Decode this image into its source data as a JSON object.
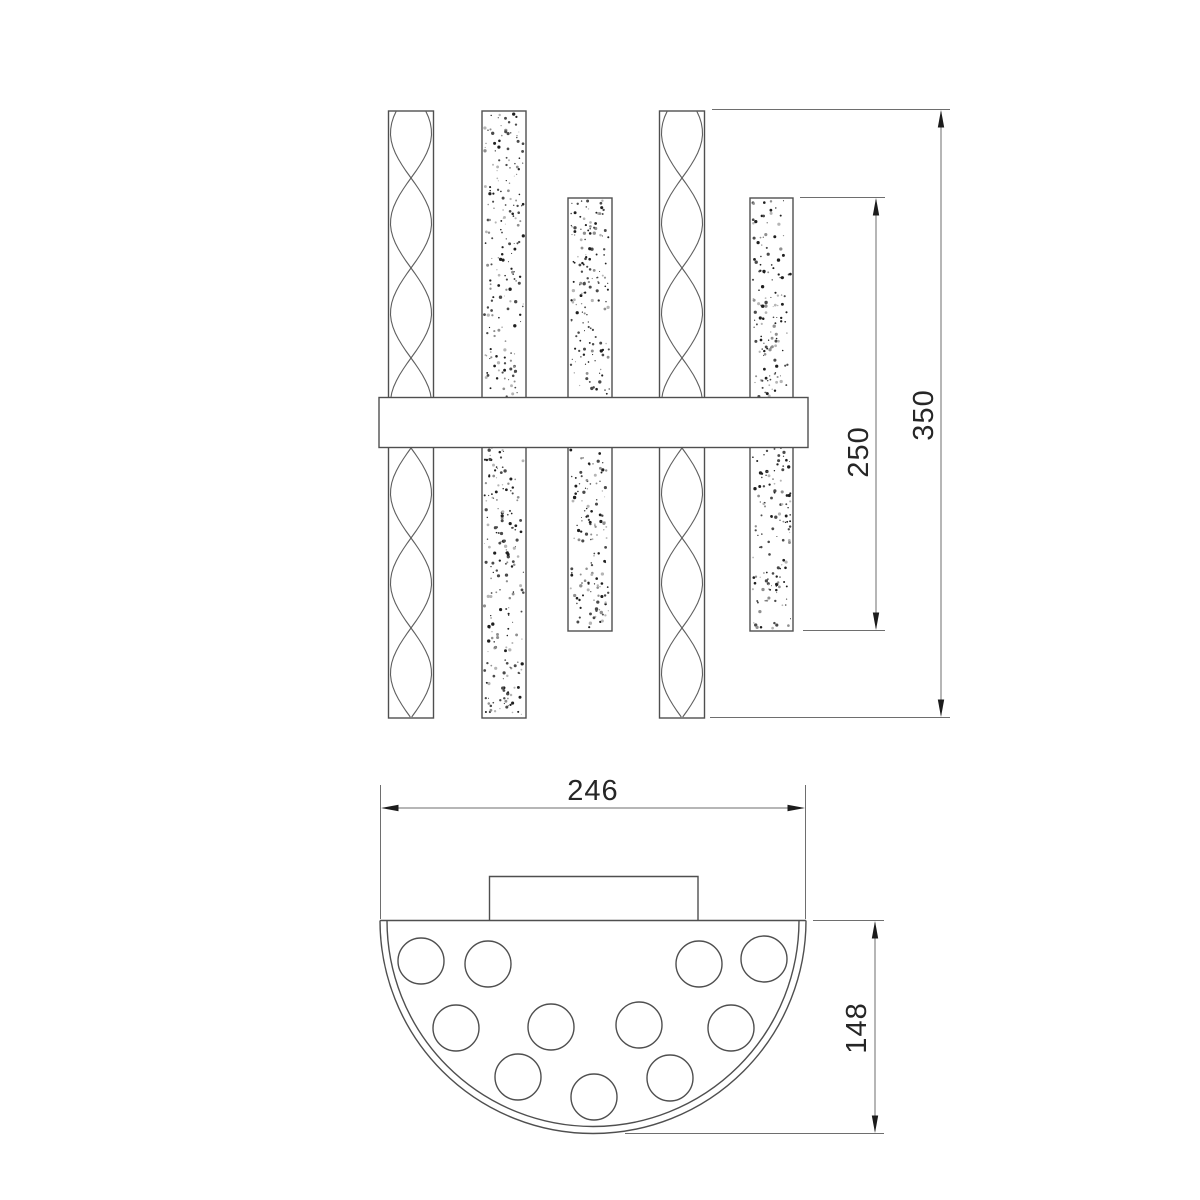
{
  "drawing": {
    "background": "#ffffff",
    "object_line_color": "#4f4f4f",
    "dimension_line_color": "#6e6e6e",
    "arrow_color": "#1c1c1c",
    "text_color": "#262626",
    "views": {
      "front_view": {
        "tube_count": 5,
        "tube_textures": [
          "twisted",
          "stippled",
          "stippled-short",
          "twisted",
          "stippled-short"
        ],
        "has_crossbar": true
      },
      "plan_view": {
        "shape": "semicircle",
        "hole_count": 11,
        "has_mounting_plate": true
      }
    },
    "dimensions": {
      "front_overall_height": "350",
      "front_tube_length": "250",
      "plan_width": "246",
      "plan_depth": "148"
    }
  }
}
